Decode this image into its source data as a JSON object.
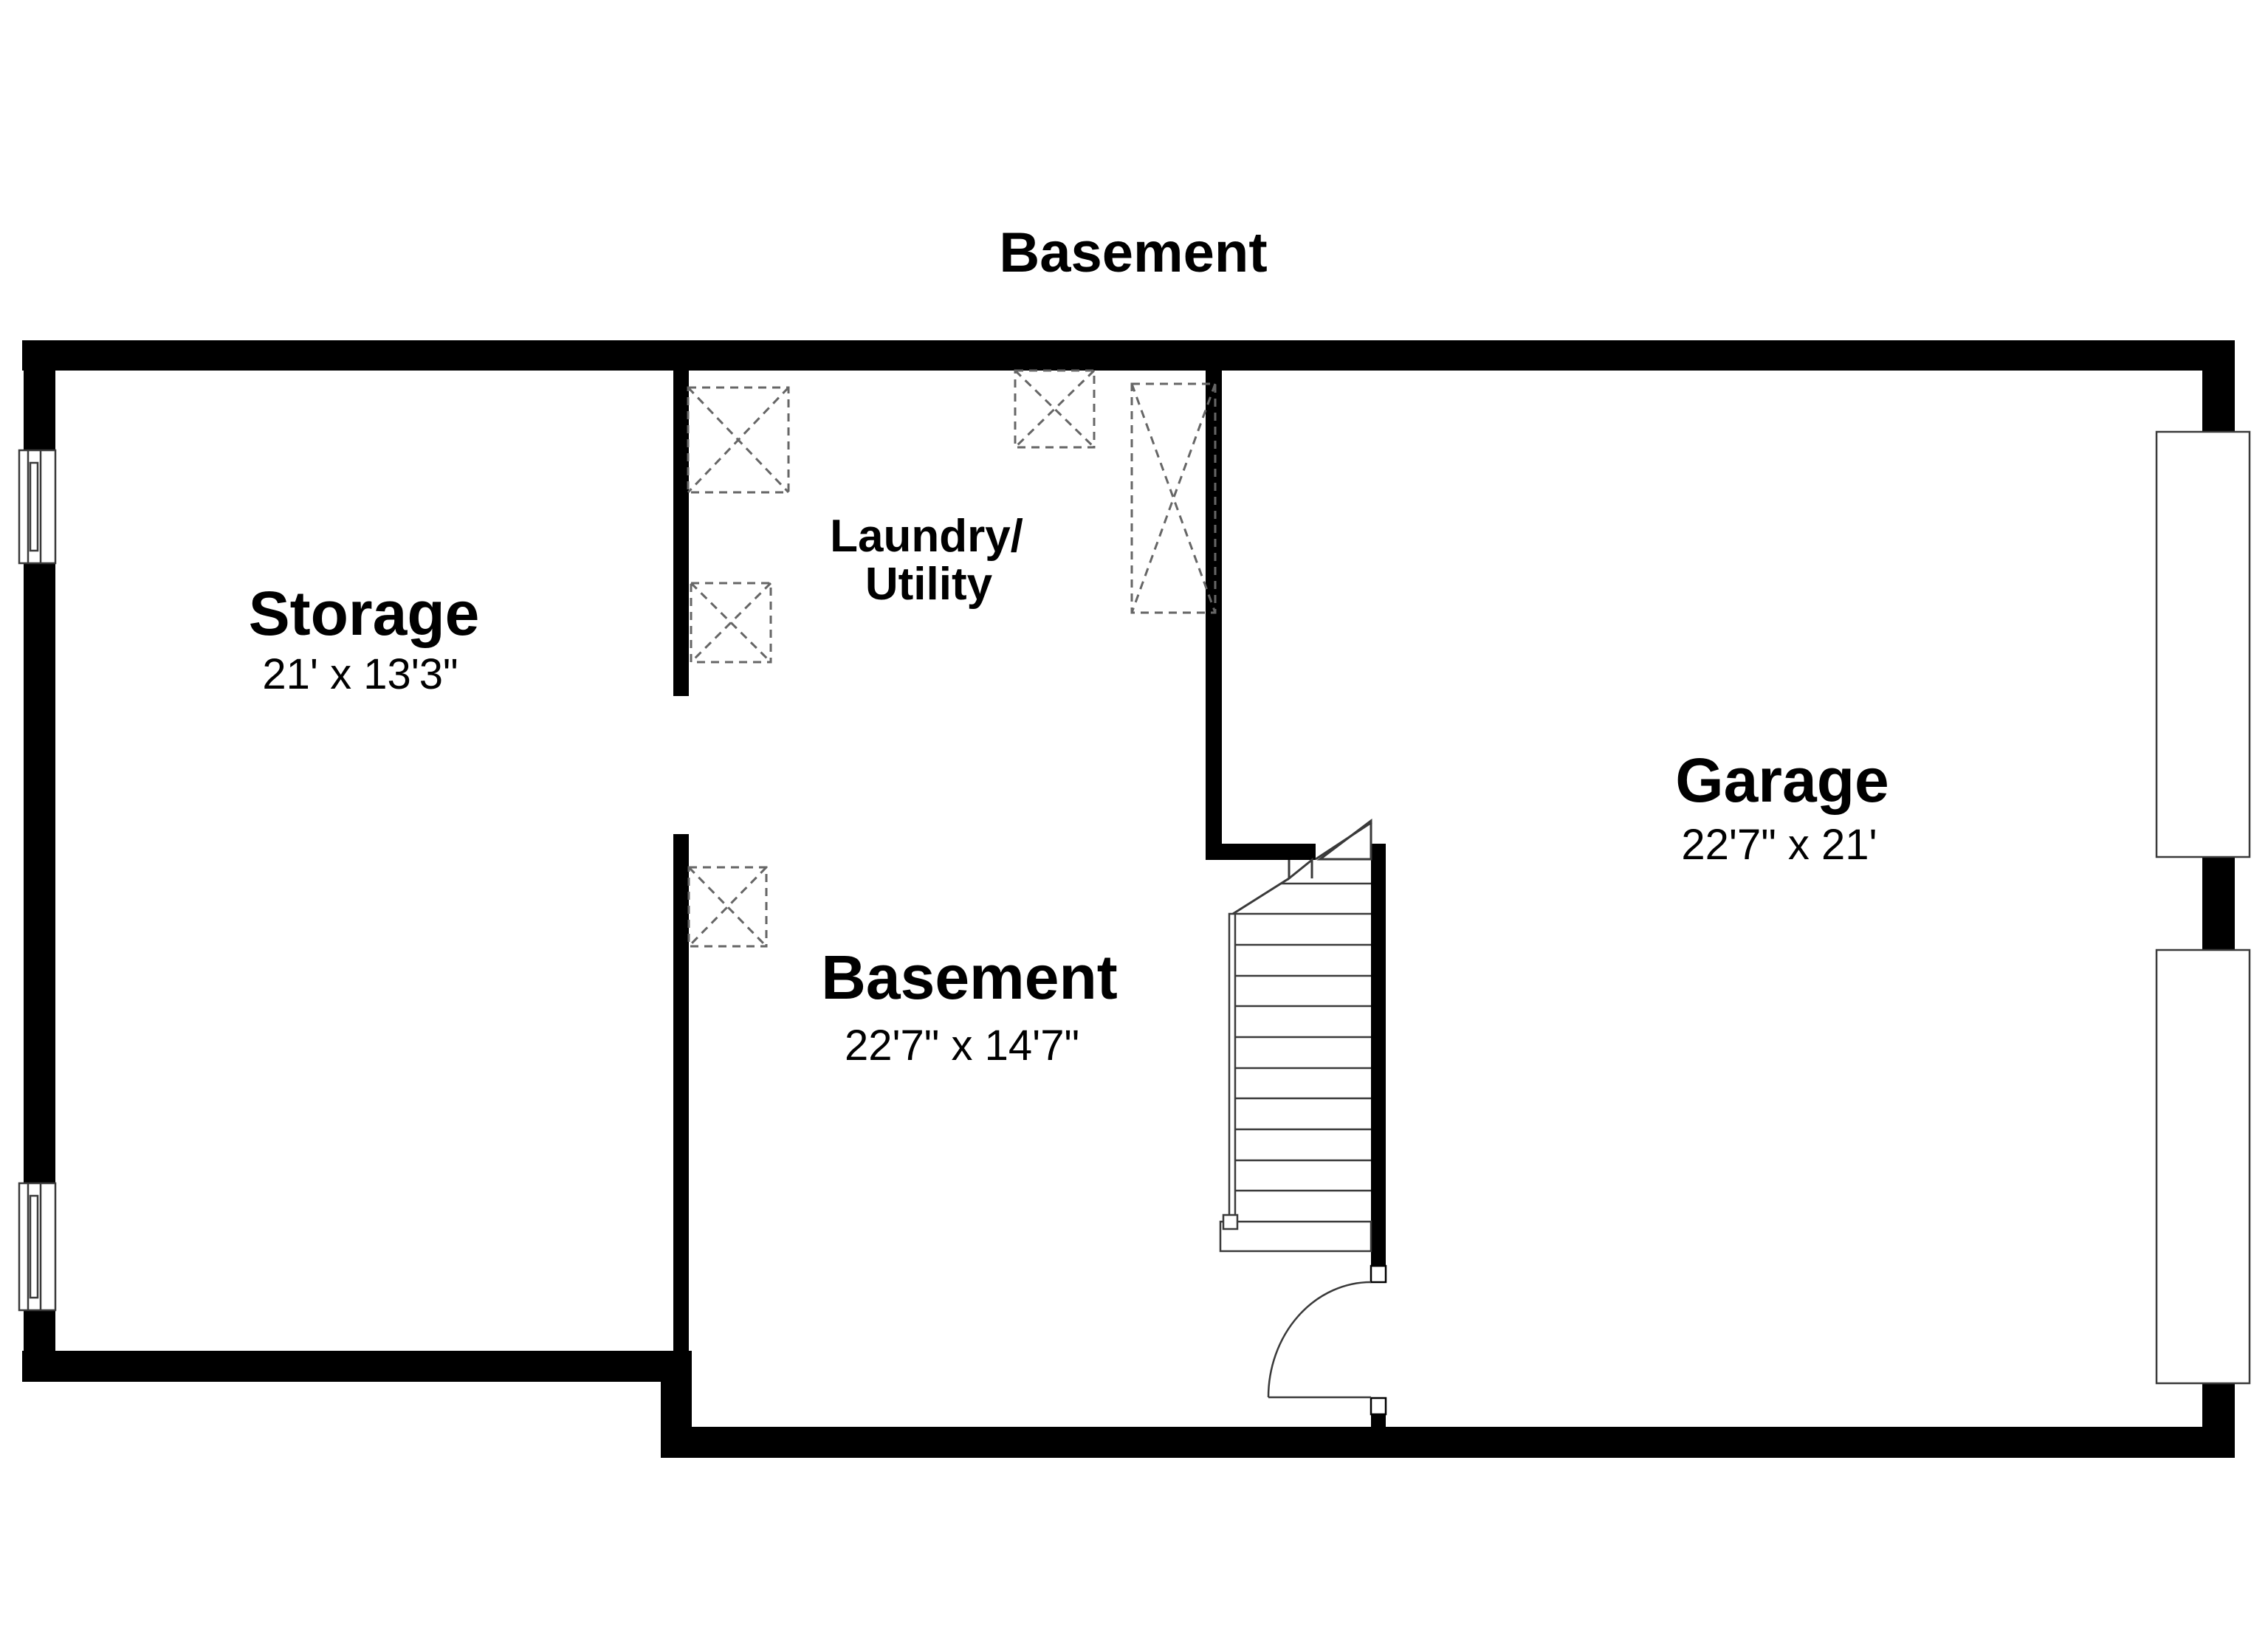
{
  "plan_title": "Basement",
  "rooms": {
    "storage": {
      "name": "Storage",
      "dims": "21' x 13'3\""
    },
    "laundry": {
      "name_line1": "Laundry/",
      "name_line2": "Utility"
    },
    "basement": {
      "name": "Basement",
      "dims": "22'7\" x 14'7\""
    },
    "garage": {
      "name": "Garage",
      "dims": "22'7\" x 21'"
    }
  },
  "features": {
    "staircase": "staircase",
    "door_swing": "door-swing",
    "windows": "window-symbol",
    "garage_openings": "garage-door-opening",
    "utility_fixtures": "utility-fixture-dashed-box"
  },
  "colors": {
    "background": "#ffffff",
    "wall": "#000000",
    "line": "#3a3a3a",
    "fixture": "#666666",
    "text": "#000000"
  }
}
